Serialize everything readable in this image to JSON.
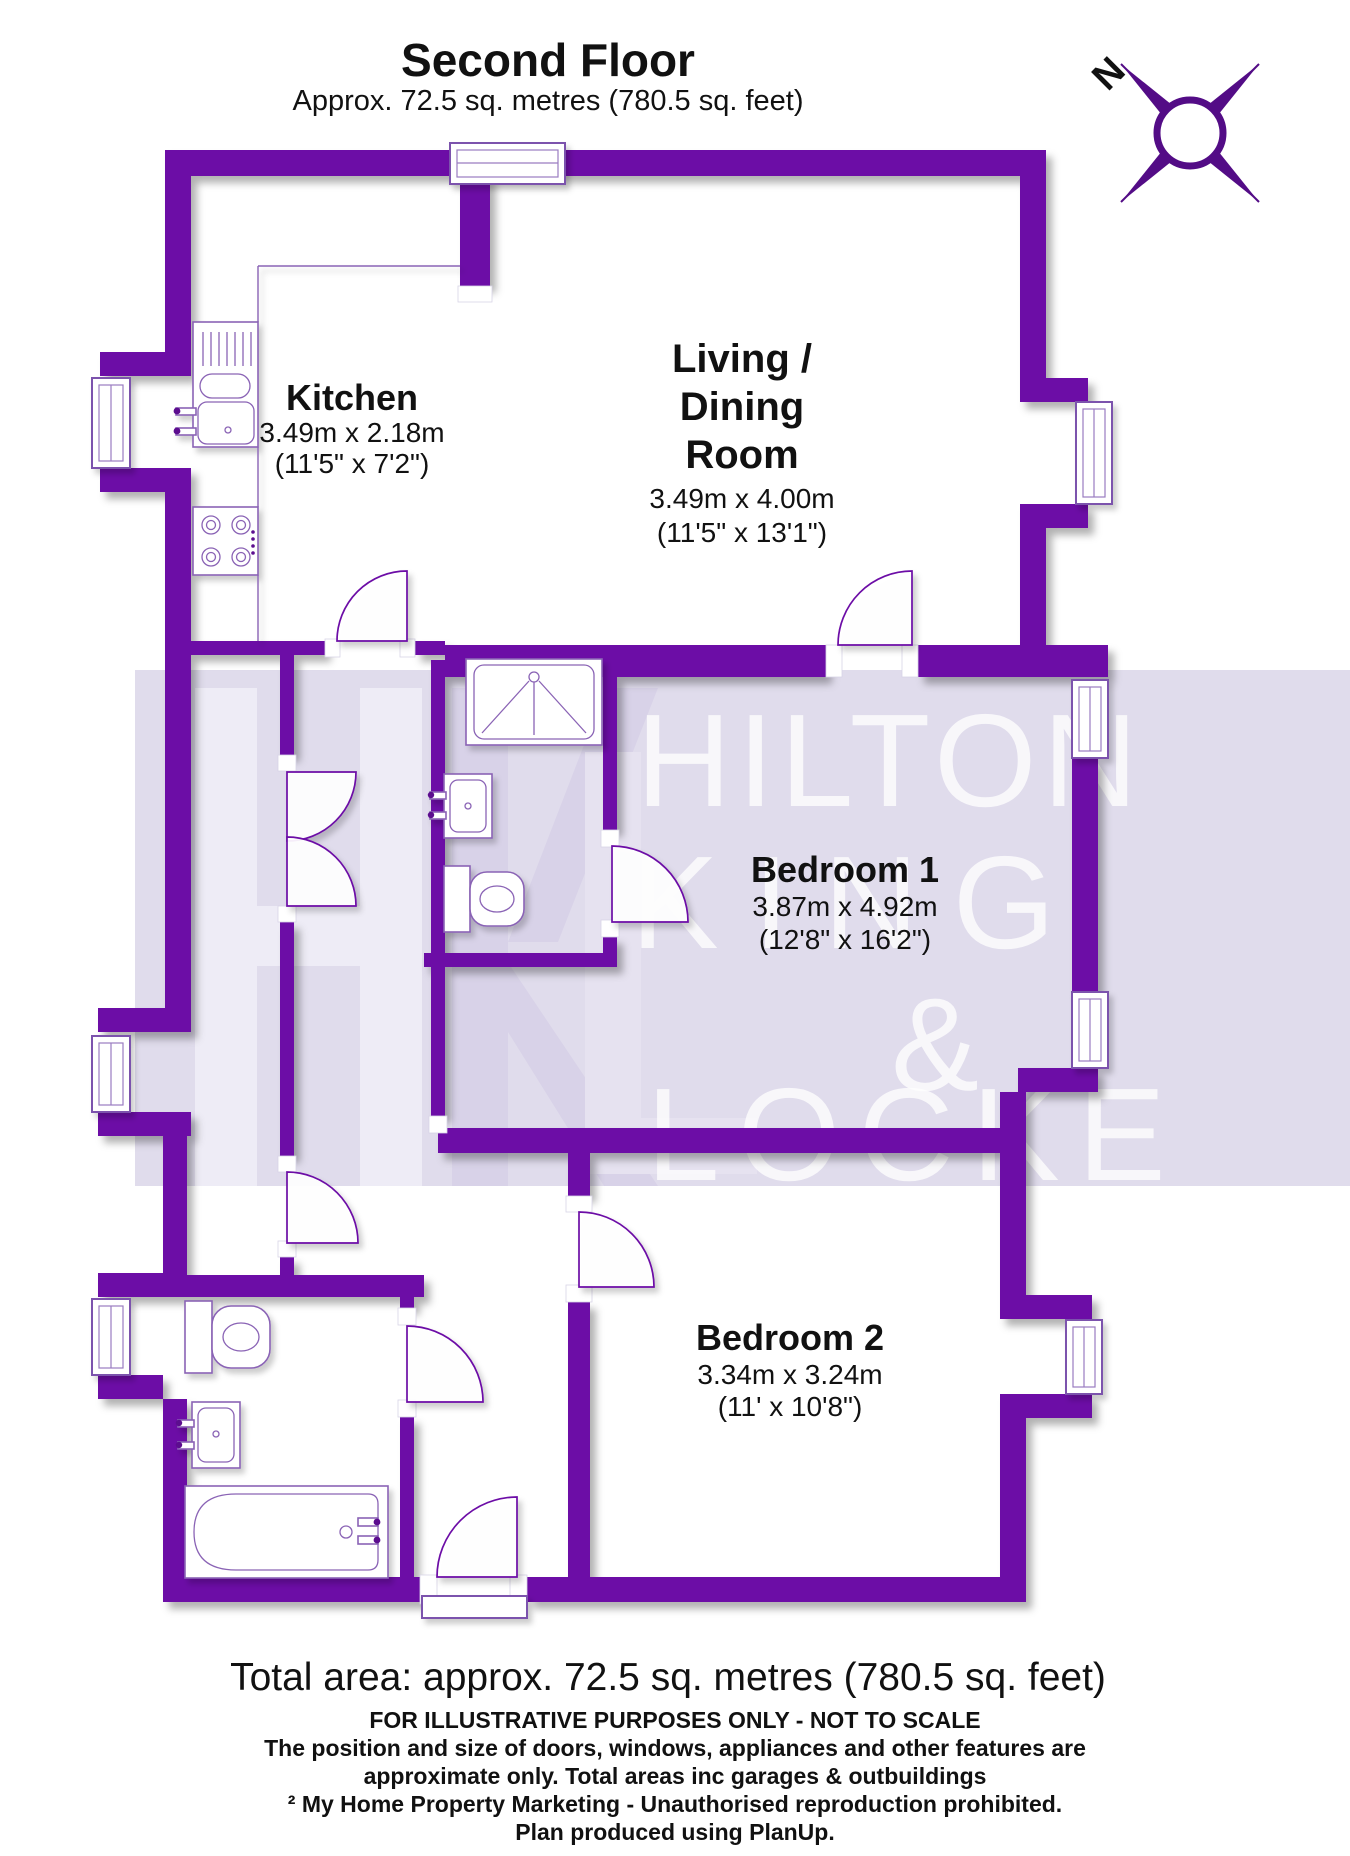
{
  "header": {
    "title": "Second Floor",
    "subtitle": "Approx. 72.5 sq. metres (780.5 sq. feet)"
  },
  "compass": {
    "north": "N"
  },
  "rooms": {
    "kitchen": {
      "name": "Kitchen",
      "metric": "3.49m x 2.18m",
      "imperial": "(11'5\" x 7'2\")"
    },
    "living": {
      "line1": "Living /",
      "line2": "Dining",
      "line3": "Room",
      "metric": "3.49m x 4.00m",
      "imperial": "(11'5\" x 13'1\")"
    },
    "bedroom1": {
      "name": "Bedroom 1",
      "metric": "3.87m x 4.92m",
      "imperial": "(12'8\" x 16'2\")"
    },
    "bedroom2": {
      "name": "Bedroom 2",
      "metric": "3.34m x 3.24m",
      "imperial": "(11' x 10'8\")"
    }
  },
  "watermark": {
    "line1": "HILTON",
    "line2": "KING",
    "line3": "&",
    "line4": "LOCKE"
  },
  "footer": {
    "total": "Total area: approx. 72.5 sq. metres (780.5 sq. feet)",
    "disclaimer": "FOR ILLUSTRATIVE PURPOSES ONLY - NOT TO SCALE",
    "position_line": "The position and size of doors, windows, appliances and other features are",
    "approx_line": "approximate only. Total areas inc garages & outbuildings",
    "copyright": "² My Home Property Marketing - Unauthorised reproduction prohibited.",
    "produced": "Plan produced using PlanUp."
  },
  "colors": {
    "wall": "#6c0aa6",
    "compass": "#530c86",
    "watermark_band": "#dad6e9",
    "text": "#111111"
  }
}
